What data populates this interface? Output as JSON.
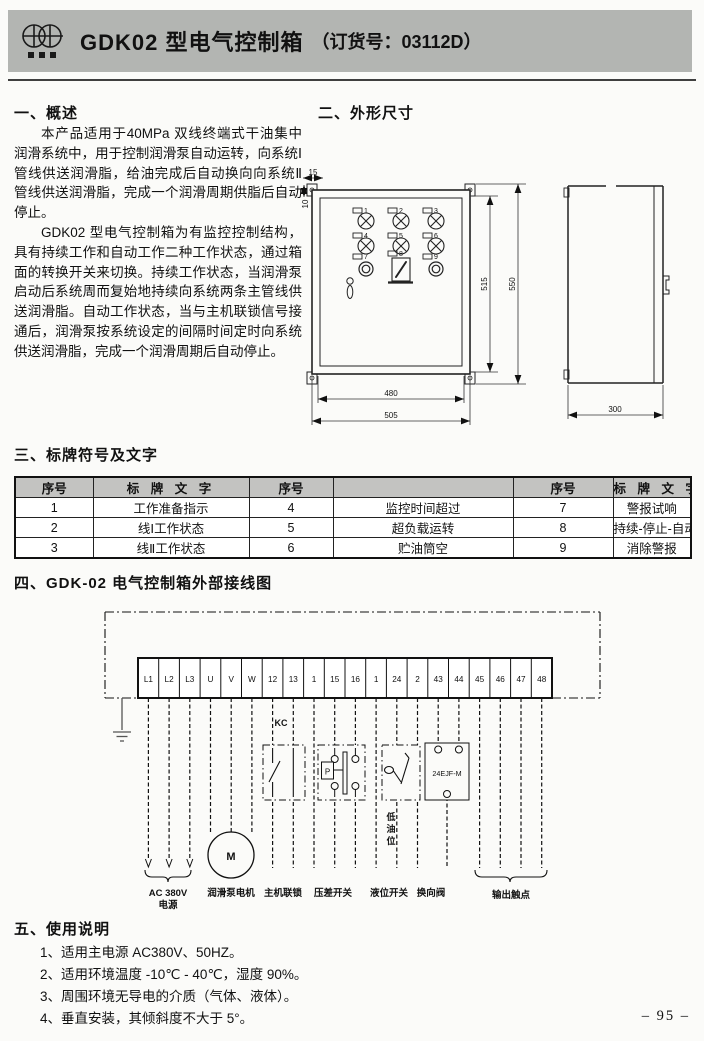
{
  "page_number": "– 95 –",
  "header": {
    "title": "GDK02 型电气控制箱",
    "order_label": "（订货号：03112D）"
  },
  "overview": {
    "heading": "一、概述",
    "para1": "本产品适用于40MPa 双线终端式干油集中润滑系统中，用于控制润滑泵自动运转，向系统Ⅰ管线供送润滑脂，给油完成后自动换向向系统Ⅱ管线供送润滑脂，完成一个润滑周期供脂后自动停止。",
    "para2": "GDK02 型电气控制箱为有监控控制结构，具有持续工作和自动工作二种工作状态，通过箱面的转换开关来切换。持续工作状态，当润滑泵启动后系统周而复始地持续向系统两条主管线供送润滑脂。自动工作状态，当与主机联锁信号接通后，润滑泵按系统设定的间隔时间定时向系统供送润滑脂，完成一个润滑周期后自动停止。"
  },
  "dimensions": {
    "heading": "二、外形尺寸",
    "dims": {
      "top_w": "15",
      "top_h": "10",
      "inner_h": "515",
      "outer_h": "550",
      "inner_w": "480",
      "outer_w": "505",
      "depth": "300"
    },
    "panel_numbers": [
      "1",
      "2",
      "3",
      "4",
      "5",
      "6",
      "7",
      "8",
      "9"
    ]
  },
  "nameplate": {
    "heading": "三、标牌符号及文字",
    "headers": [
      "序号",
      "标 牌 文 字",
      "序号",
      "",
      "序号",
      "标 牌 文 字"
    ],
    "rows": [
      [
        "1",
        "工作准备指示",
        "4",
        "监控时间超过",
        "7",
        "警报试响"
      ],
      [
        "2",
        "线Ⅰ工作状态",
        "5",
        "超负载运转",
        "8",
        "持续-停止-自动"
      ],
      [
        "3",
        "线Ⅱ工作状态",
        "6",
        "贮油筒空",
        "9",
        "消除警报"
      ]
    ]
  },
  "wiring": {
    "heading": "四、GDK-02 电气控制箱外部接线图",
    "terminals": [
      "L1",
      "L2",
      "L3",
      "U",
      "V",
      "W",
      "12",
      "13",
      "1",
      "15",
      "16",
      "1",
      "24",
      "2",
      "43",
      "44",
      "45",
      "46",
      "47",
      "48"
    ],
    "motor_label": "M",
    "kc_label": "KC",
    "pressure_label": "P",
    "valve_label": "24EJF-M",
    "low_oil_chars": [
      "低",
      "油",
      "位"
    ],
    "bottom_labels": [
      "AC 380V",
      "电源",
      "润滑泵电机",
      "主机联锁",
      "压差开关",
      "液位开关",
      "换向阀",
      "输出触点"
    ]
  },
  "usage": {
    "heading": "五、使用说明",
    "items": [
      "1、适用主电源 AC380V、50HZ。",
      "2、适用环境温度 -10℃ - 40℃，湿度 90%。",
      "3、周围环境无导电的介质（气体、液体）。",
      "4、垂直安装，其倾斜度不大于 5°。"
    ]
  }
}
